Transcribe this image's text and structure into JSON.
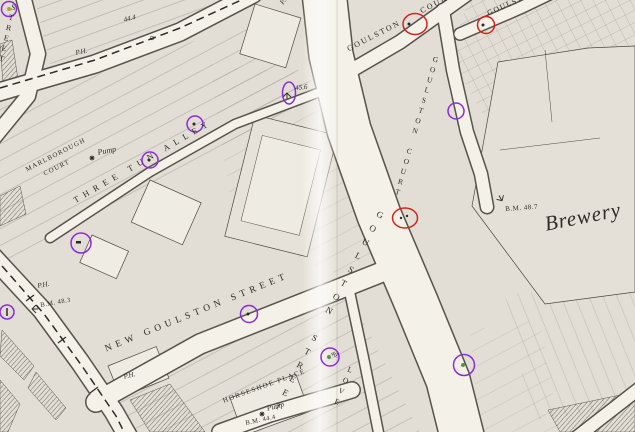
{
  "colors": {
    "paper": "#e2ded5",
    "street": "#f4f1e9",
    "ink": "#2c2a26",
    "purple_annotation": "#8b2bd9",
    "red_annotation": "#d0241c",
    "green_dot": "#5d8f4f",
    "yellow_dot": "#b3a02e"
  },
  "annotations": {
    "purple_marker_count": "10",
    "red_marker_count": "3"
  },
  "labels": {
    "street_left": "STREET",
    "spot_height_top": "44.4",
    "ph": "P.H.",
    "goulston_court_upper_1": "GOULSTON",
    "goulston_court_upper_2": "COURT",
    "goulston_court_upper_right": "GOULSTON C",
    "goulston_court_vertical": "GOULSTON COURT",
    "goulston_street": "GOULSTON STREET",
    "new_goulston_street": "NEW GOULSTON STREET",
    "three_tun_alley": "THREE TUN ALLEY",
    "marlborough_1": "MARLBOROUGH",
    "marlborough_2": "COURT",
    "pump": "Pump",
    "spot_height_alley": "45.6",
    "bm_48_7": "B.M. 48.7",
    "bm_48_3": "B.M. 48.3",
    "bm_44_4": "B.M. 44.4",
    "spot_height_love": "40.",
    "love_court": "LOVE",
    "brewery": "Brewery"
  }
}
